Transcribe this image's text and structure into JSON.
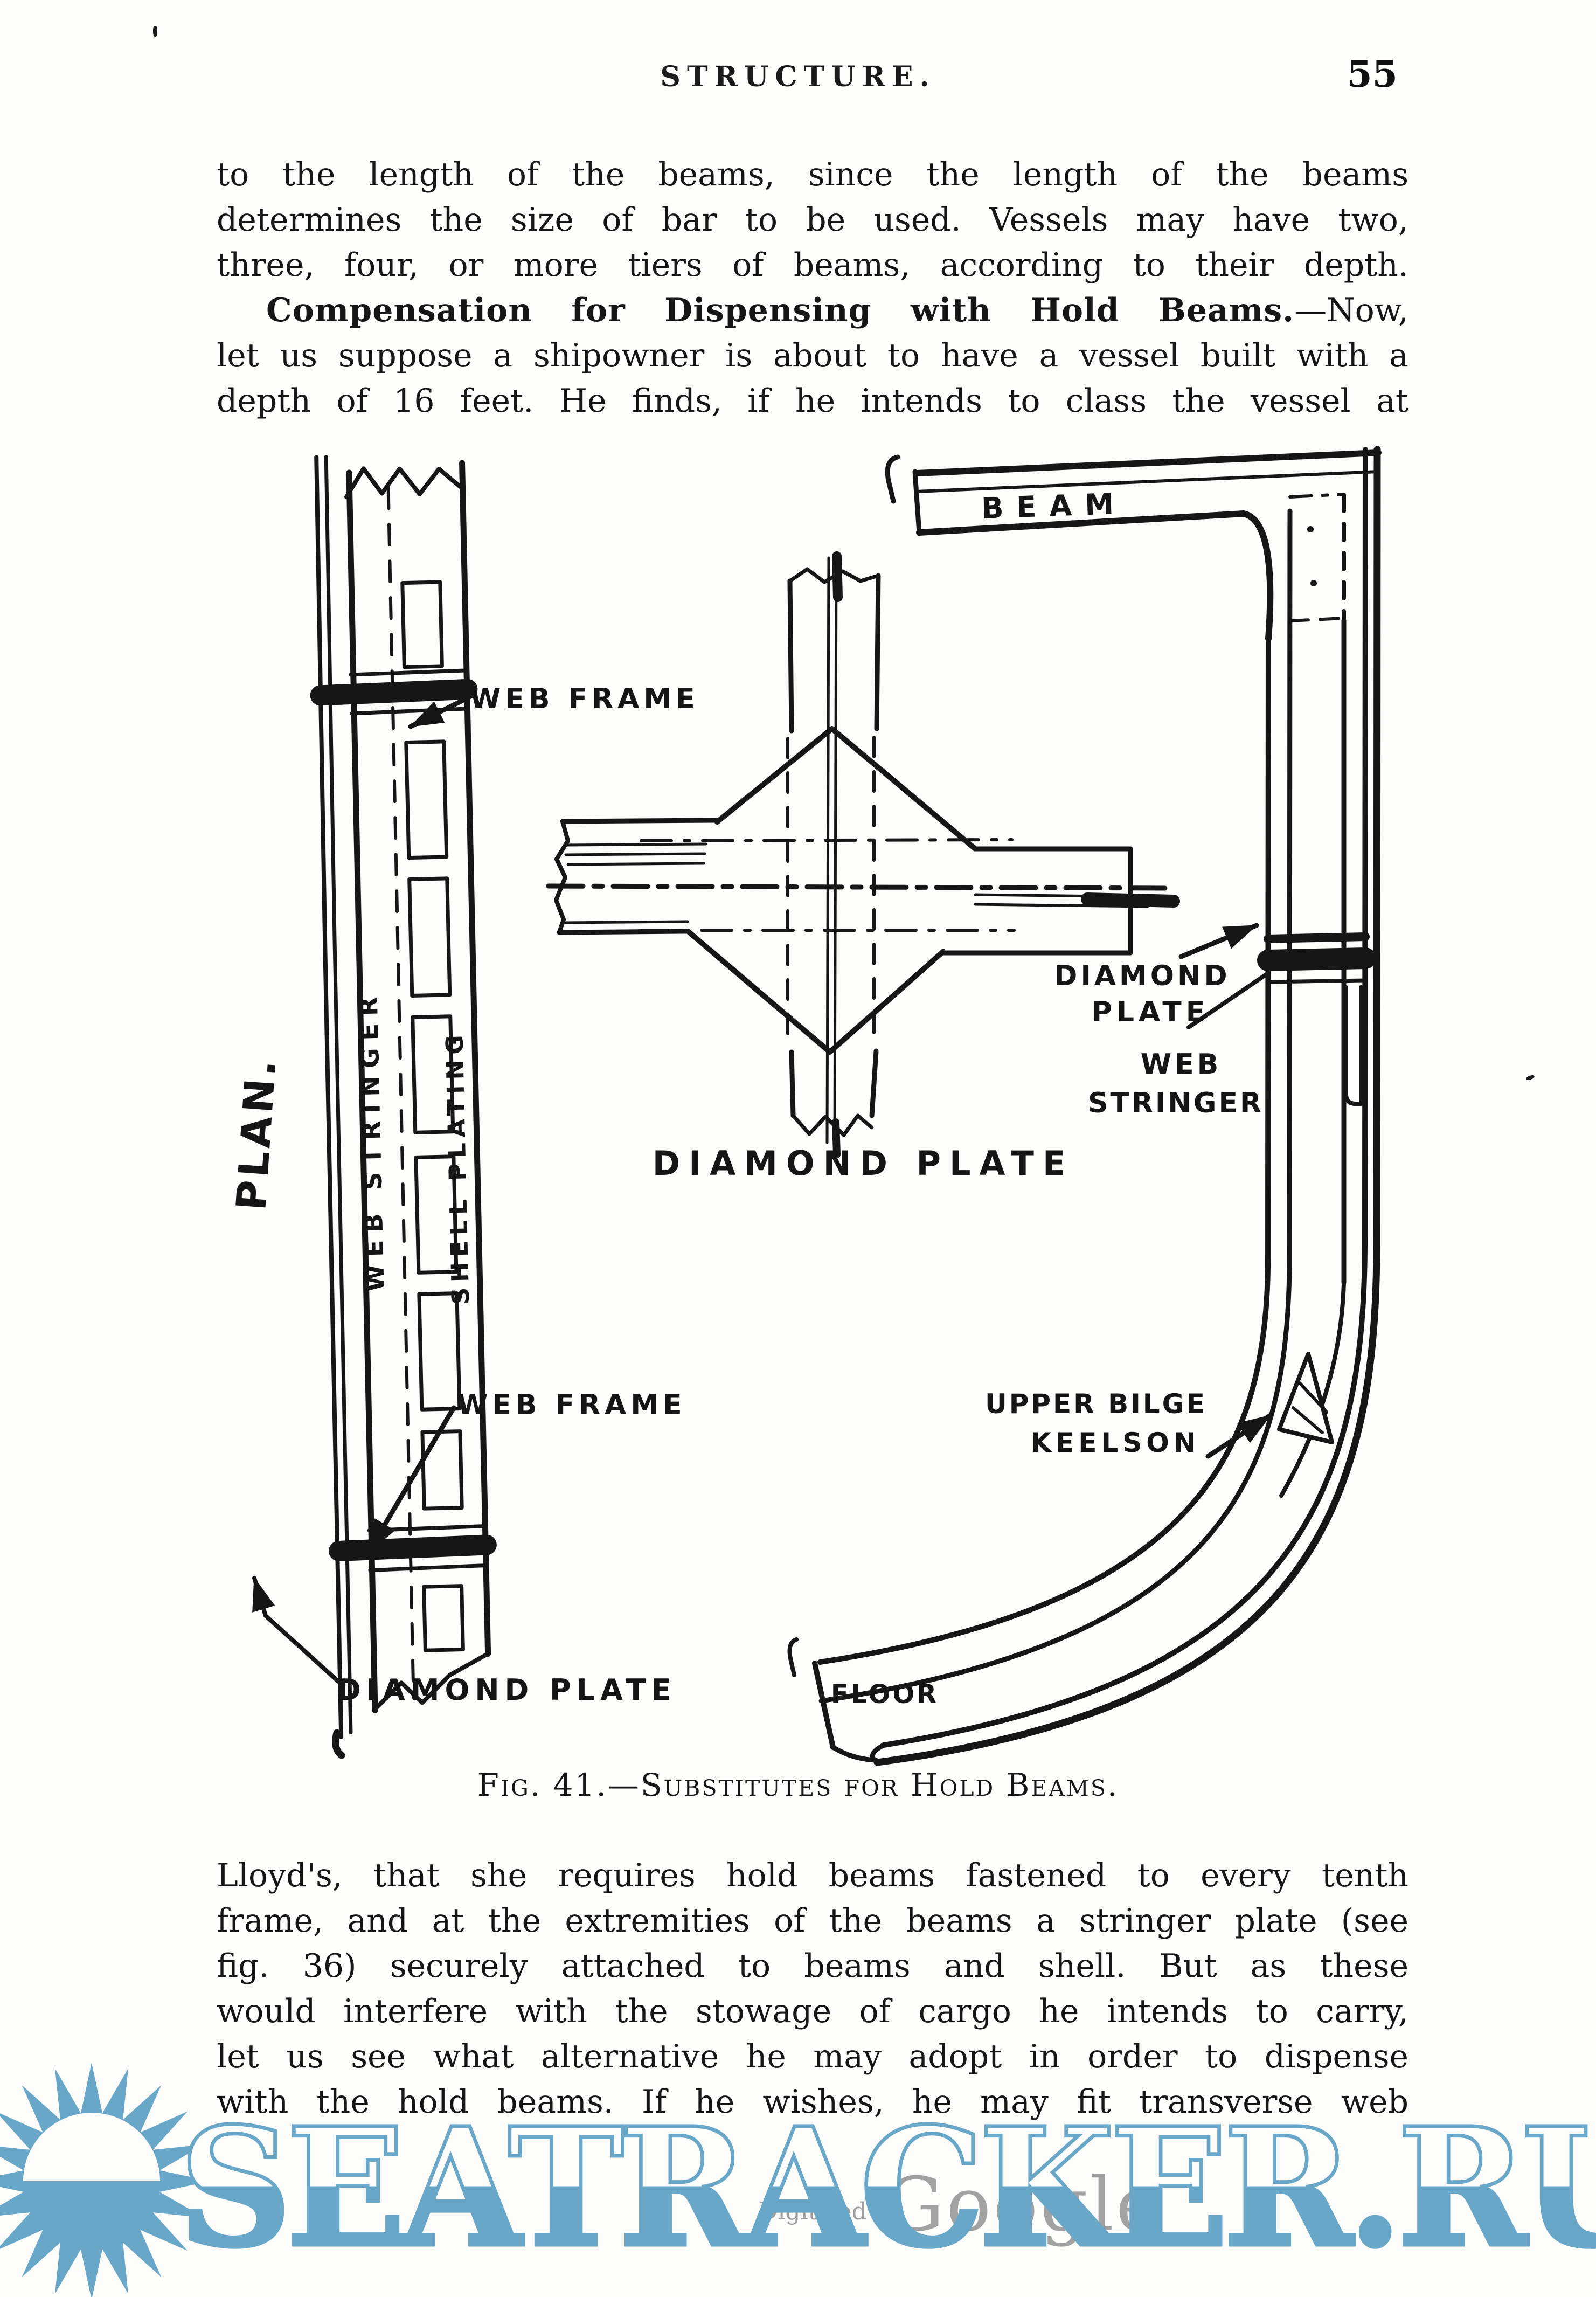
{
  "header": {
    "title": "STRUCTURE.",
    "page_number": "55"
  },
  "para1_lines": [
    "to the length of the beams, since the length of the beams",
    "determines the size of bar to be used.  Vessels may have two,",
    "three, four, or more tiers of beams, according to their depth."
  ],
  "para2": {
    "lead_bold": "Compensation for Dispensing with Hold Beams.",
    "lead_rest": "—Now,",
    "lines": [
      "let us suppose a shipowner is about to have a vessel built with a",
      "depth of 16 feet.  He finds, if he intends to class the vessel at"
    ]
  },
  "figure": {
    "caption": "Fig. 41.—Substitutes for Hold Beams.",
    "labels": {
      "web_frame_top": "WEB FRAME",
      "beam": "BEAM",
      "plan": "PLAN.",
      "web_stringer_vertical": "WEB STRINGER",
      "shell_plating": "SHELL PLATING",
      "diamond_plate_caption": "DIAMOND PLATE",
      "diamond_right_1": "DIAMOND",
      "diamond_right_2": "PLATE",
      "web_right_1": "WEB",
      "web_right_2": "STRINGER",
      "bilge_1": "UPPER BILGE",
      "bilge_2": "KEELSON",
      "web_frame_bottom": "WEB FRAME",
      "diamond_plate_bottom": "DIAMOND PLATE",
      "floor": "FLOOR"
    }
  },
  "para3_lines": [
    "Lloyd's, that she requires hold beams fastened to every tenth",
    "frame, and at the extremities of the beams a stringer plate (see",
    "fig. 36) securely attached to beams and shell.  But as these",
    "would interfere with the stowage of cargo he intends to carry,",
    "let us see what alternative he may adopt in order to dispense",
    "with the hold beams.  If he wishes, he may fit transverse web"
  ],
  "watermark": {
    "text": "SEATRACKER.RU",
    "color": "#69a7c8"
  },
  "digitized": {
    "prefix": "Digitized by",
    "brand": "Google"
  },
  "colors": {
    "paper": "#fdfdfc",
    "ink": "#161616",
    "watermark_blue": "#69a7c8",
    "digitized_gray": "#9b9b9b"
  }
}
